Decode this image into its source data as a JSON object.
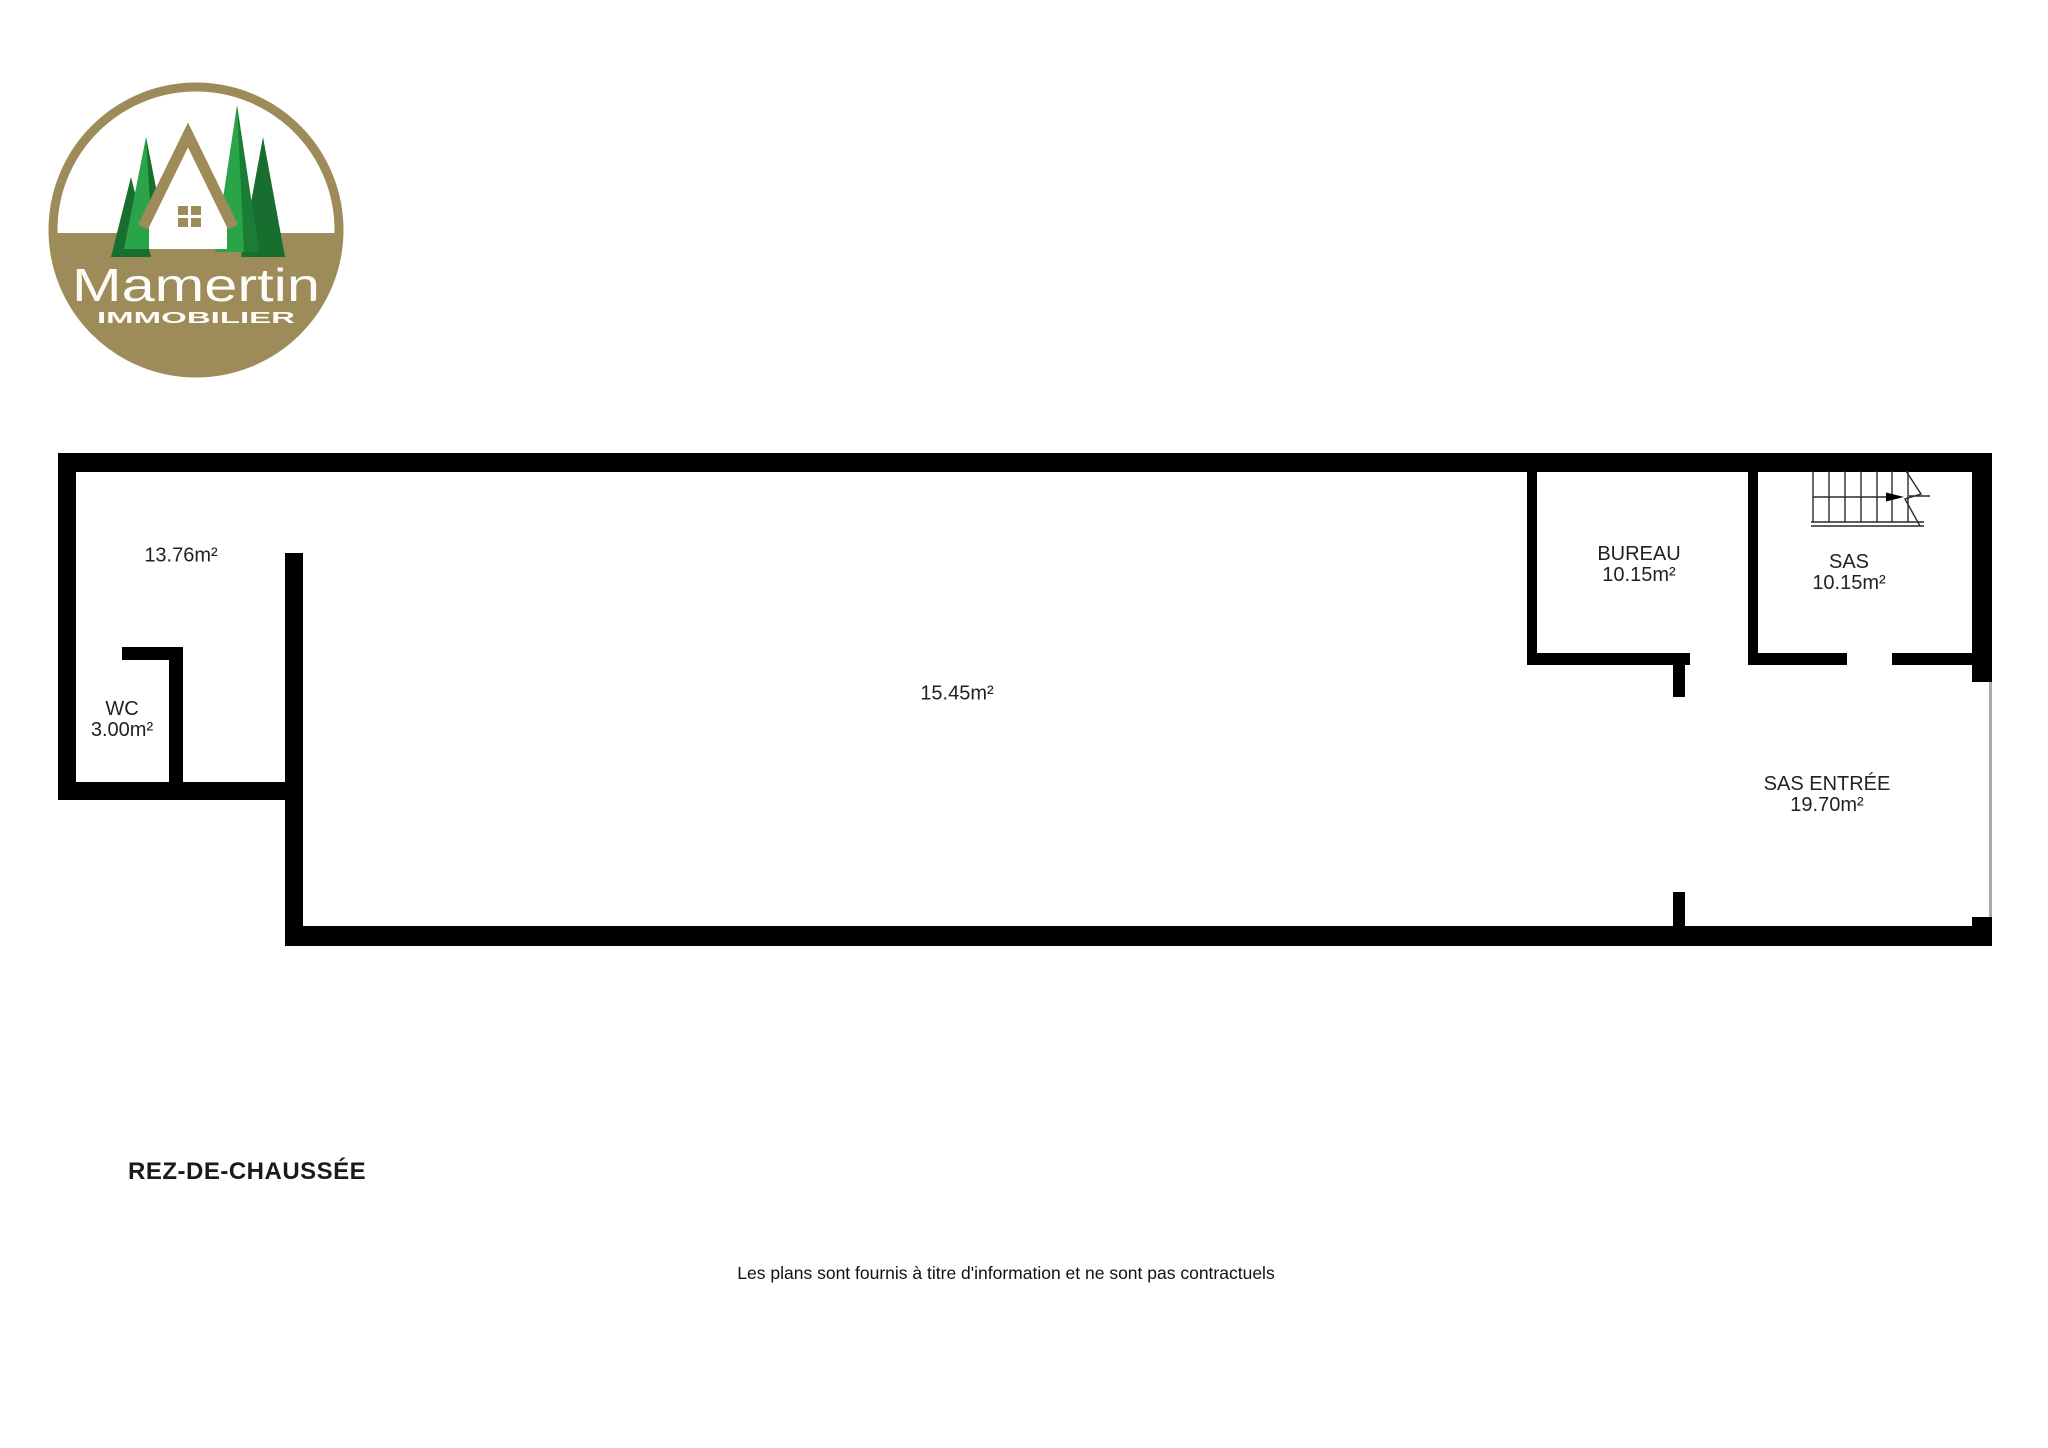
{
  "logo": {
    "brand": "Mamertin",
    "tagline": "IMMOBILIER",
    "colors": {
      "gold": "#9d8b59",
      "green_bright": "#2aa449",
      "green_dark": "#176e2f",
      "text": "#fdfcf8"
    }
  },
  "plan": {
    "wall_color": "#000000",
    "label_color": "#222222",
    "rooms": [
      {
        "name": "",
        "area": "13.76m²"
      },
      {
        "name": "WC",
        "area": "3.00m²"
      },
      {
        "name": "",
        "area": "15.45m²"
      },
      {
        "name": "BUREAU",
        "area": "10.15m²"
      },
      {
        "name": "SAS",
        "area": "10.15m²"
      },
      {
        "name": "SAS ENTRÉE",
        "area": "19.70m²"
      }
    ],
    "stairs": {
      "icon": "stairs-with-direction-arrow"
    }
  },
  "footer": {
    "floor_label": "REZ-DE-CHAUSSÉE",
    "disclaimer": "Les plans sont fournis à titre d'information et ne sont pas contractuels"
  }
}
